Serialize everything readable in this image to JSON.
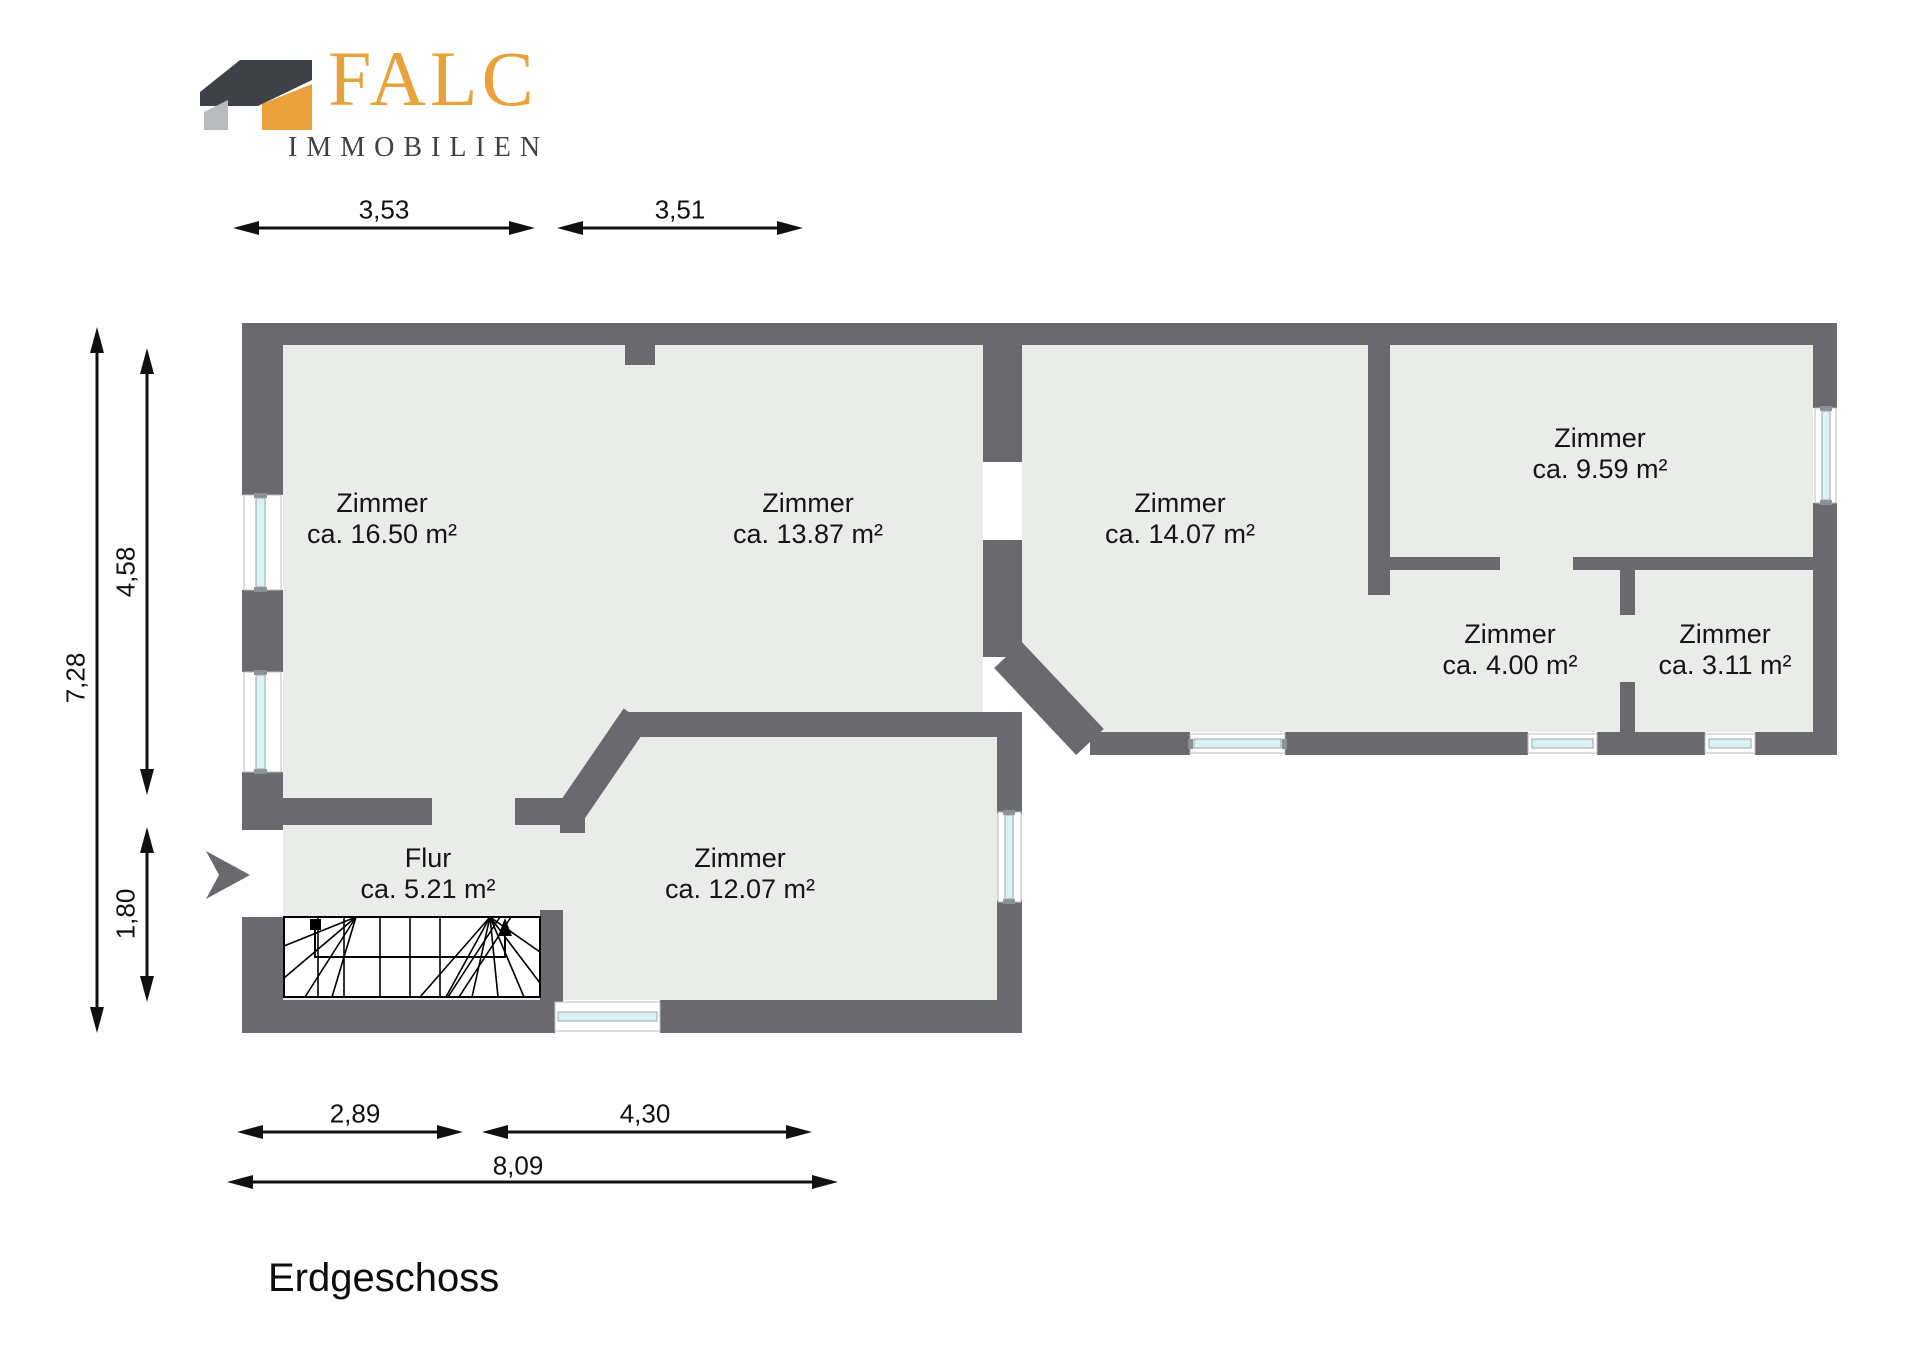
{
  "logo": {
    "brand": "FALC",
    "subtitle": "IMMOBILIEN"
  },
  "title": "Erdgeschoss",
  "rooms": [
    {
      "name": "Zimmer",
      "area": "ca. 16.50 m²"
    },
    {
      "name": "Zimmer",
      "area": "ca. 13.87 m²"
    },
    {
      "name": "Zimmer",
      "area": "ca. 14.07 m²"
    },
    {
      "name": "Zimmer",
      "area": "ca. 9.59 m²"
    },
    {
      "name": "Zimmer",
      "area": "ca. 4.00 m²"
    },
    {
      "name": "Zimmer",
      "area": "ca. 3.11 m²"
    },
    {
      "name": "Flur",
      "area": "ca. 5.21 m²"
    },
    {
      "name": "Zimmer",
      "area": "ca. 12.07 m²"
    }
  ],
  "dimensions": {
    "top_left": "3,53",
    "top_right": "3,51",
    "side_total": "7,28",
    "side_upper": "4,58",
    "side_lower": "1,80",
    "bottom_left": "2,89",
    "bottom_right": "4,30",
    "bottom_total": "8,09"
  },
  "colors": {
    "wall": "#6a6a6e",
    "floor": "#e9ece8",
    "window": "#d9f3f5",
    "logo_orange": "#e9a23b",
    "logo_dark": "#3e4248",
    "logo_gray": "#b9bcbe"
  }
}
